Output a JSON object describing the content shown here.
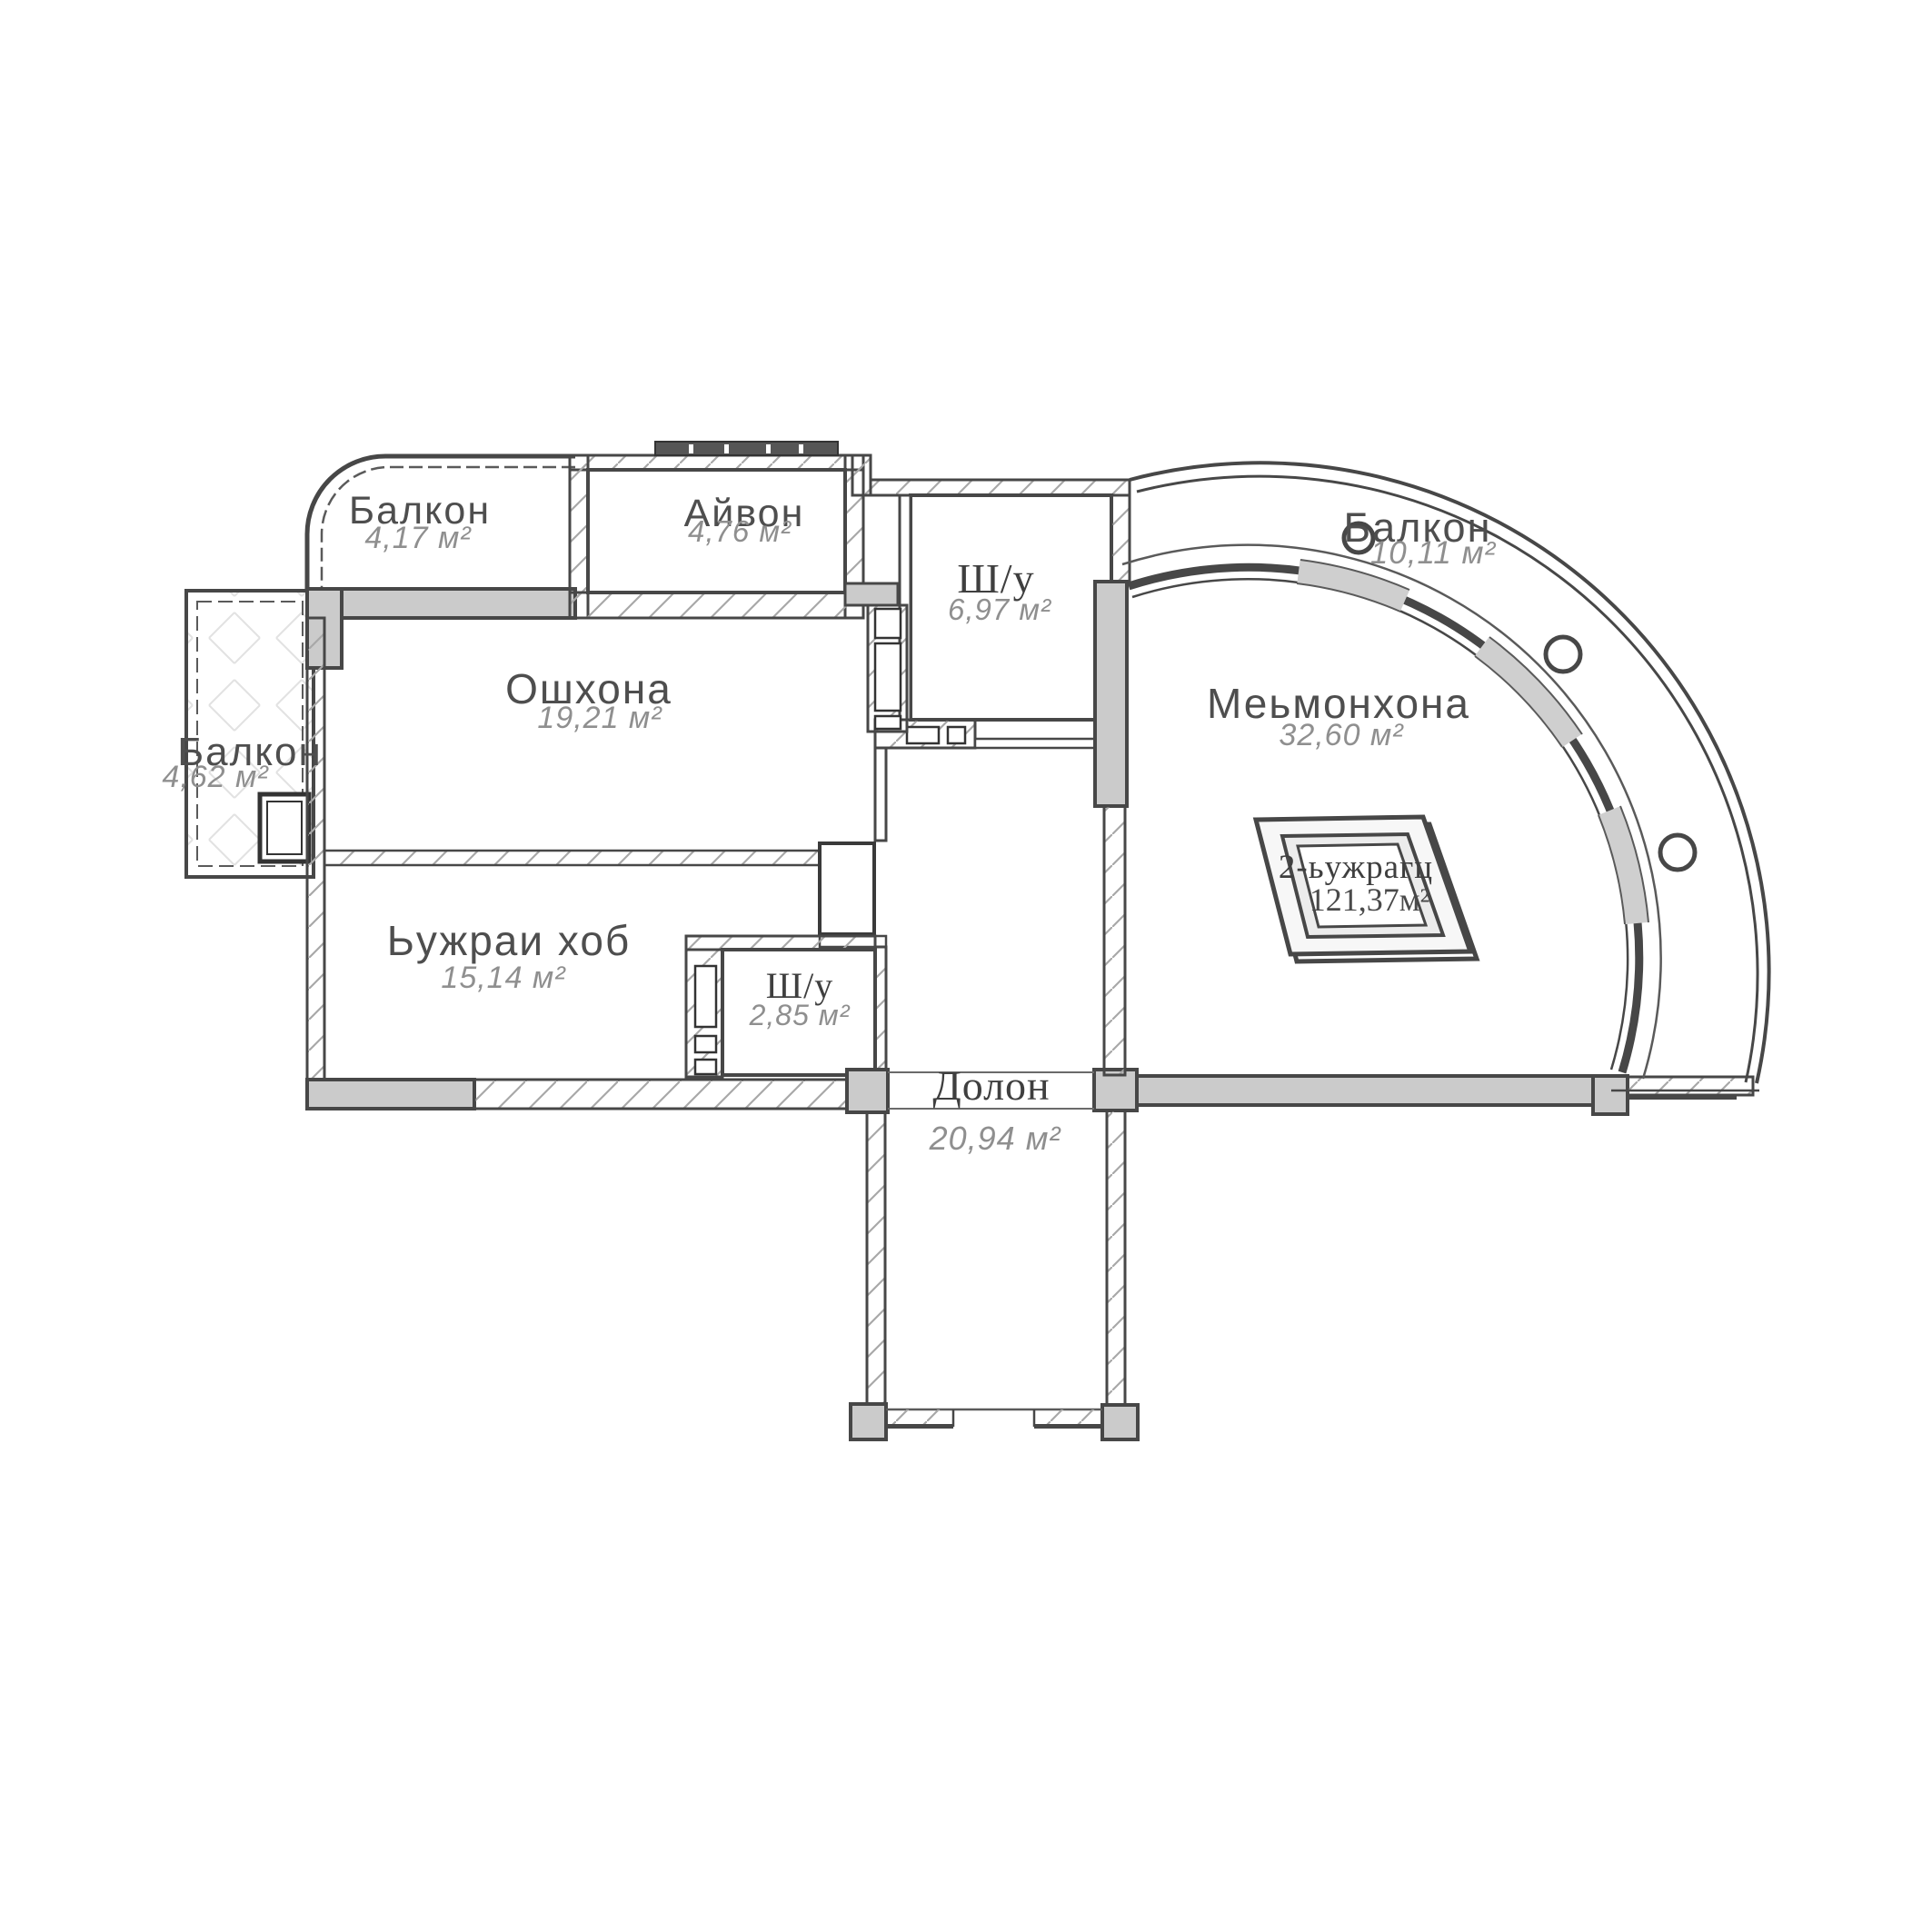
{
  "title": "Floor plan — 2-room apartment",
  "unit_label": {
    "name": "2-ьужрагц",
    "area": "121,37м²"
  },
  "rooms": [
    {
      "id": "balcony-top-left",
      "name": "Балкон",
      "area": "4,17 м²"
    },
    {
      "id": "ayvon",
      "name": "Айвон",
      "area": "4,76 м²"
    },
    {
      "id": "shu-top",
      "name": "Ш/у",
      "area": "6,97 м²"
    },
    {
      "id": "balcony-right",
      "name": "Балкон",
      "area": "10,11 м²"
    },
    {
      "id": "balcony-left",
      "name": "Балкон",
      "area": "4,62 м²"
    },
    {
      "id": "oshxona",
      "name": "Ошхона",
      "area": "19,21 м²"
    },
    {
      "id": "mehmonxona",
      "name": "Меьмонхона",
      "area": "32,60 м²"
    },
    {
      "id": "bujrai-hob",
      "name": "Ьужраи хоб",
      "area": "15,14 м²"
    },
    {
      "id": "shu-small",
      "name": "Ш/у",
      "area": "2,85 м²"
    },
    {
      "id": "dolon",
      "name": "Долон",
      "area": "20,94 м²"
    }
  ],
  "colors": {
    "wall_line": "#474747",
    "concrete_fill": "#cbcbcb",
    "window_fill": "#cfcfcf",
    "hatch_line": "#a8a8a8",
    "label_text": "#4e4e4e",
    "area_text": "#8f8f8f",
    "background": "#ffffff"
  }
}
